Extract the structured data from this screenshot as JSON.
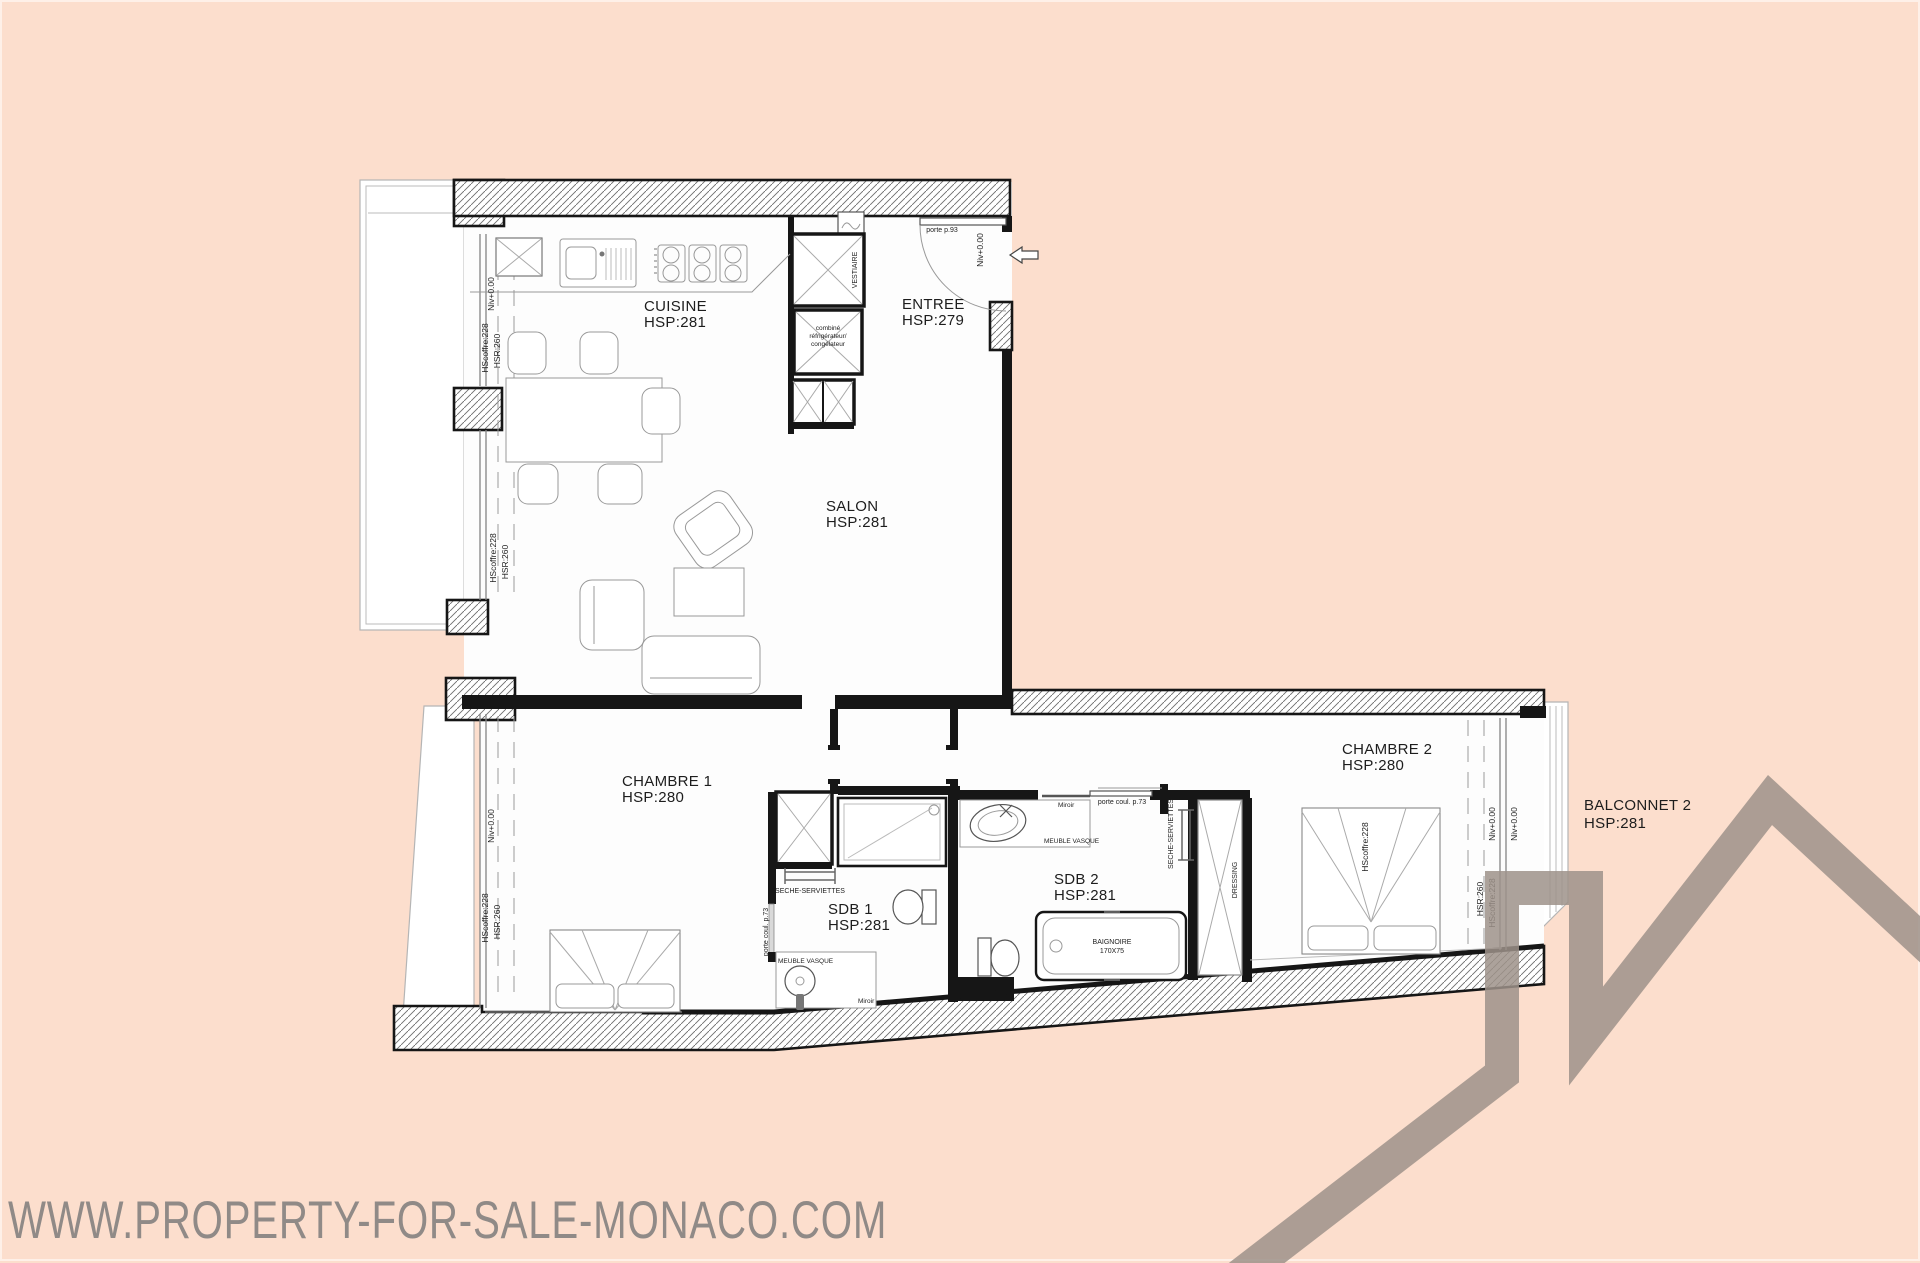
{
  "watermark": "WWW.PROPERTY-FOR-SALE-MONACO.COM",
  "colors": {
    "background": "#fcdecd",
    "wall": "#161616",
    "logo": "#a09288",
    "watermark_text": "#787878"
  },
  "rooms": {
    "cuisine": {
      "name": "CUISINE",
      "hsp": "HSP:281"
    },
    "entree": {
      "name": "ENTREE",
      "hsp": "HSP:279"
    },
    "salon": {
      "name": "SALON",
      "hsp": "HSP:281"
    },
    "chambre1": {
      "name": "CHAMBRE 1",
      "hsp": "HSP:280"
    },
    "sdb1": {
      "name": "SDB 1",
      "hsp": "HSP:281"
    },
    "sdb2": {
      "name": "SDB 2",
      "hsp": "HSP:281"
    },
    "chambre2": {
      "name": "CHAMBRE 2",
      "hsp": "HSP:280"
    },
    "balconnet2": {
      "name": "BALCONNET 2",
      "hsp": "HSP:281"
    }
  },
  "annotations": {
    "porte_entree": "porte p.93",
    "niv": "Niv+0.00",
    "hscoffre": "HScoffre:228",
    "hsr": "HSR:260",
    "vestiaire": "VESTIAIRE",
    "fridge_l1": "combiné",
    "fridge_l2": "réfrigérateur/",
    "fridge_l3": "congélateur",
    "seche_serviettes": "SECHE-SERVIETTES",
    "porte_coul": "porte coul. p.73",
    "meuble_vasque": "MEUBLE VASQUE",
    "miroir": "Miroir",
    "baignoire": "BAIGNOIRE",
    "baignoire_dim": "170X75",
    "dressing": "DRESSING"
  }
}
